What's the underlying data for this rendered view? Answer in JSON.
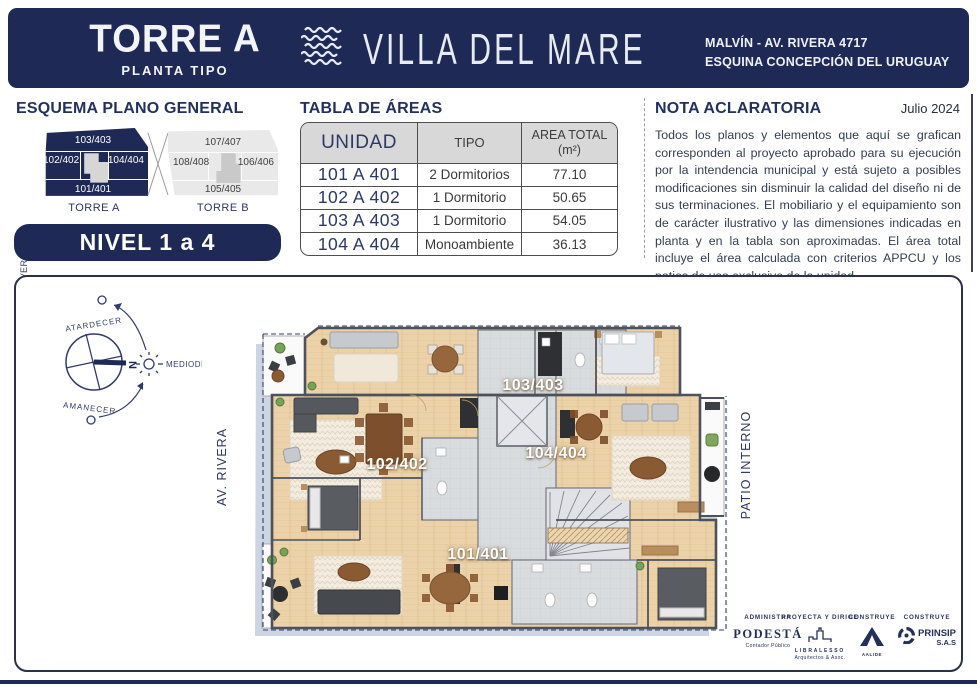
{
  "header": {
    "tower": "TORRE A",
    "subtitle": "PLANTA TIPO",
    "brand": "VILLA DEL MARE",
    "address1": "MALVÍN - AV. RIVERA 4717",
    "address2": "ESQUINA CONCEPCIÓN DEL URUGUAY"
  },
  "esquema": {
    "title": "ESQUEMA PLANO GENERAL",
    "street": "AV. RIVERA",
    "torre_a": {
      "caption": "TORRE A",
      "top": "103/403",
      "left": "102/402",
      "right": "104/404",
      "bottom": "101/401"
    },
    "torre_b": {
      "caption": "TORRE B",
      "top": "107/407",
      "left": "108/408",
      "right": "106/406",
      "bottom": "105/405"
    },
    "badge": "NIVEL 1 a 4"
  },
  "tabla": {
    "title": "TABLA DE ÁREAS",
    "col_unidad": "UNIDAD",
    "col_tipo": "TIPO",
    "col_area_1": "AREA TOTAL",
    "col_area_2": "(m²)",
    "rows": [
      {
        "unidad": "101 A 401",
        "tipo": "2 Dormitorios",
        "area": "77.10"
      },
      {
        "unidad": "102 A 402",
        "tipo": "1 Dormitorio",
        "area": "50.65"
      },
      {
        "unidad": "103 A 403",
        "tipo": "1 Dormitorio",
        "area": "54.05"
      },
      {
        "unidad": "104 A 404",
        "tipo": "Monoambiente",
        "area": "36.13"
      }
    ]
  },
  "nota": {
    "title": "NOTA ACLARATORIA",
    "date": "Julio 2024",
    "body": "Todos los planos y elementos que aquí se grafican corresponden al proyecto aprobado para su ejecución por la intendencia municipal y está sujeto a posibles modificaciones sin disminuir la calidad del diseño ni de sus terminaciones. El mobiliario y el equipamiento son de carácter ilustrativo y las dimensiones indicadas en planta y en la tabla son aproximadas. El área total incluye el área calculada con criterios APPCU y los patios de uso exclusivo de la unidad."
  },
  "plan": {
    "street": "AV. RIVERA",
    "patio": "PATIO INTERNO",
    "units": {
      "u103": "103/403",
      "u102": "102/402",
      "u104": "104/404",
      "u101": "101/401"
    },
    "compass": {
      "n": "N",
      "top": "ATARDECER",
      "right": "MEDIODÍA",
      "bottom": "AMANECER"
    }
  },
  "logos": [
    {
      "role": "ADMINISTRA",
      "name": "PODESTÁ",
      "sub": "Contador Público"
    },
    {
      "role": "PROYECTA Y DIRIGE",
      "name": "LIBRALESSO",
      "sub": "Arquitectos & Asoc."
    },
    {
      "role": "CONSTRUYE",
      "name": "AALIDE",
      "sub": ""
    },
    {
      "role": "CONSTRUYE",
      "name": "PRINSIP",
      "sub": "S.A.S"
    }
  ],
  "colors": {
    "navy": "#1e2a55",
    "wood": "#ecd2a9",
    "gray_tile": "#d9dcdf",
    "table_header": "#d8d8d8"
  }
}
